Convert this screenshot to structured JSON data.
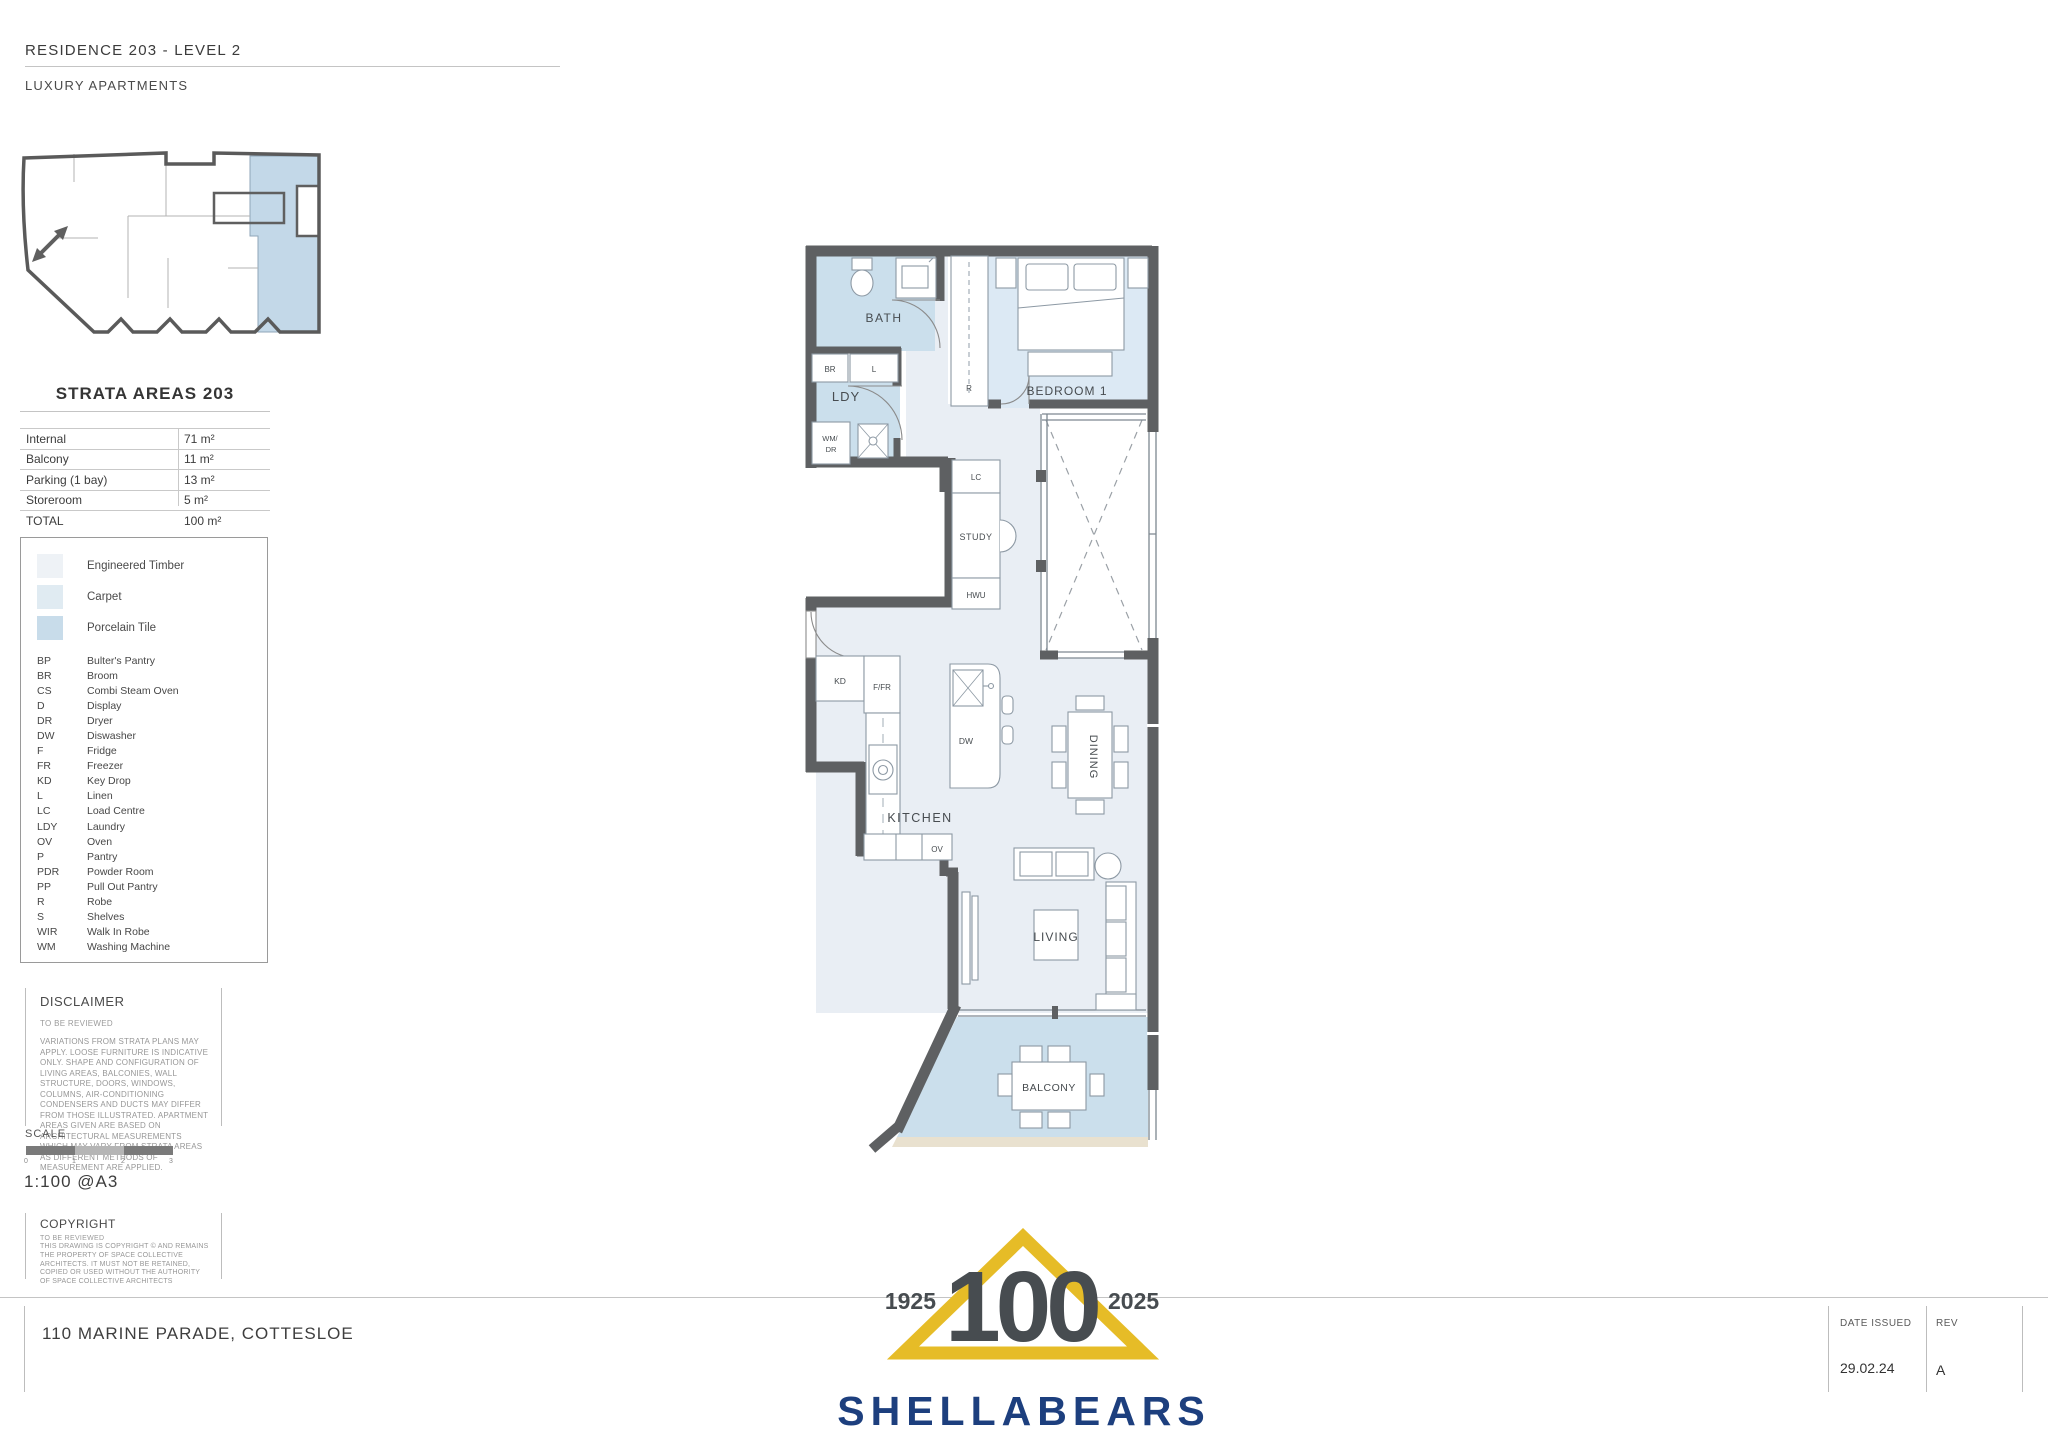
{
  "header": {
    "title": "RESIDENCE 203 - LEVEL 2",
    "subtitle": "LUXURY APARTMENTS"
  },
  "strata": {
    "title": "STRATA AREAS 203",
    "rows": [
      {
        "label": "Internal",
        "value": "71 m²"
      },
      {
        "label": "Balcony",
        "value": "11 m²"
      },
      {
        "label": "Parking (1 bay)",
        "value": "13 m²"
      },
      {
        "label": "Storeroom",
        "value": "5 m²"
      },
      {
        "label": "TOTAL",
        "value": "100 m²"
      }
    ]
  },
  "legend": {
    "materials": [
      {
        "name": "Engineered Timber",
        "color": "#eef2f6"
      },
      {
        "name": "Carpet",
        "color": "#e0ebf2"
      },
      {
        "name": "Porcelain Tile",
        "color": "#c8dcea"
      }
    ],
    "abbreviations": [
      {
        "code": "BP",
        "label": "Bulter's Pantry"
      },
      {
        "code": "BR",
        "label": "Broom"
      },
      {
        "code": "CS",
        "label": "Combi Steam Oven"
      },
      {
        "code": "D",
        "label": "Display"
      },
      {
        "code": "DR",
        "label": "Dryer"
      },
      {
        "code": "DW",
        "label": "Diswasher"
      },
      {
        "code": "F",
        "label": "Fridge"
      },
      {
        "code": "FR",
        "label": "Freezer"
      },
      {
        "code": "KD",
        "label": "Key Drop"
      },
      {
        "code": "L",
        "label": "Linen"
      },
      {
        "code": "LC",
        "label": "Load Centre"
      },
      {
        "code": "LDY",
        "label": "Laundry"
      },
      {
        "code": "OV",
        "label": "Oven"
      },
      {
        "code": "P",
        "label": "Pantry"
      },
      {
        "code": "PDR",
        "label": "Powder Room"
      },
      {
        "code": "PP",
        "label": "Pull Out Pantry"
      },
      {
        "code": "R",
        "label": "Robe"
      },
      {
        "code": "S",
        "label": "Shelves"
      },
      {
        "code": "WIR",
        "label": "Walk In Robe"
      },
      {
        "code": "WM",
        "label": "Washing Machine"
      }
    ]
  },
  "disclaimer": {
    "title": "DISCLAIMER",
    "note": "TO BE REVIEWED",
    "body": "VARIATIONS FROM STRATA PLANS MAY APPLY. LOOSE FURNITURE IS INDICATIVE ONLY. SHAPE AND CONFIGURATION OF LIVING AREAS, BALCONIES, WALL STRUCTURE, DOORS, WINDOWS, COLUMNS, AIR-CONDITIONING CONDENSERS AND DUCTS MAY DIFFER FROM THOSE ILLUSTRATED. APARTMENT AREAS GIVEN ARE BASED ON ARCHITECTURAL MEASUREMENTS WHICH MAY VARY FROM STRATA AREAS AS DIFFERENT METHODS OF MEASUREMENT ARE APPLIED."
  },
  "scale": {
    "label": "SCALE",
    "ticks": [
      "0",
      "1",
      "2",
      "3"
    ],
    "ratio": "1:100 @A3"
  },
  "copyright": {
    "title": "COPYRIGHT",
    "note": "TO BE REVIEWED",
    "body": "THIS DRAWING IS COPYRIGHT © AND REMAINS THE PROPERTY OF SPACE COLLECTIVE ARCHITECTS. IT MUST NOT BE RETAINED, COPIED OR USED WITHOUT THE AUTHORITY OF SPACE COLLECTIVE ARCHITECTS"
  },
  "plan": {
    "rooms": {
      "bath": "BATH",
      "ldy": "LDY",
      "bedroom1": "BEDROOM 1",
      "study": "STUDY",
      "kitchen": "KITCHEN",
      "dining": "DINING",
      "living": "LIVING",
      "balcony": "BALCONY"
    },
    "tags": {
      "br": "BR",
      "l": "L",
      "wm": "WM/",
      "dr": "DR",
      "r": "R",
      "lc": "LC",
      "hwu": "HWU",
      "kd": "KD",
      "ffr": "F/FR",
      "dw": "DW",
      "ov": "OV"
    }
  },
  "footer": {
    "address": "110 MARINE PARADE, COTTESLOE",
    "date_issued_label": "DATE ISSUED",
    "date_issued": "29.02.24",
    "rev_label": "REV",
    "rev": "A"
  },
  "logo": {
    "year_start": "1925",
    "centenary": "100",
    "year_end": "2025",
    "brand": "SHELLABEARS",
    "gold": "#e6bc27",
    "blue": "#1d3f7e"
  }
}
